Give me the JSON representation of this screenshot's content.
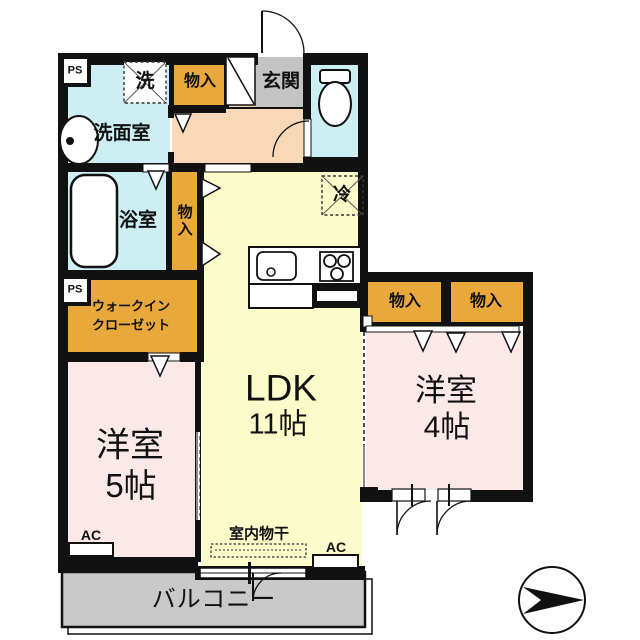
{
  "plan": {
    "rooms": {
      "washroom": {
        "label": "洗面室"
      },
      "bathroom": {
        "label": "浴室"
      },
      "entrance": {
        "label": "玄関"
      },
      "ldk": {
        "label": "LDK",
        "size": "11帖"
      },
      "western5": {
        "label": "洋室",
        "size": "5帖"
      },
      "western4": {
        "label": "洋室",
        "size": "4帖"
      },
      "wic": {
        "line1": "ウォークイン",
        "line2": "クローゼット"
      },
      "balcony": {
        "label": "バルコニー"
      }
    },
    "storage": {
      "top_label": "物入",
      "column_label": "物入",
      "wing_a_label": "物入",
      "wing_b_label": "物入"
    },
    "fixtures": {
      "washer_label": "洗",
      "fridge_label": "冷",
      "laundry_label": "室内物干"
    },
    "labels": {
      "ps_top": "PS",
      "ps_bottom": "PS",
      "ac_left": "AC",
      "ac_right": "AC"
    },
    "colors": {
      "wall": "#111111",
      "water_blue": "#cdeef2",
      "storage_orange": "#e8a83c",
      "entry_gray": "#c3c3c3",
      "balcony_gray": "#c9c9c9",
      "hall_peach": "#f8d8b6",
      "ldk_yellow": "#fbfcca",
      "room_pink": "#fbe9e8"
    }
  }
}
